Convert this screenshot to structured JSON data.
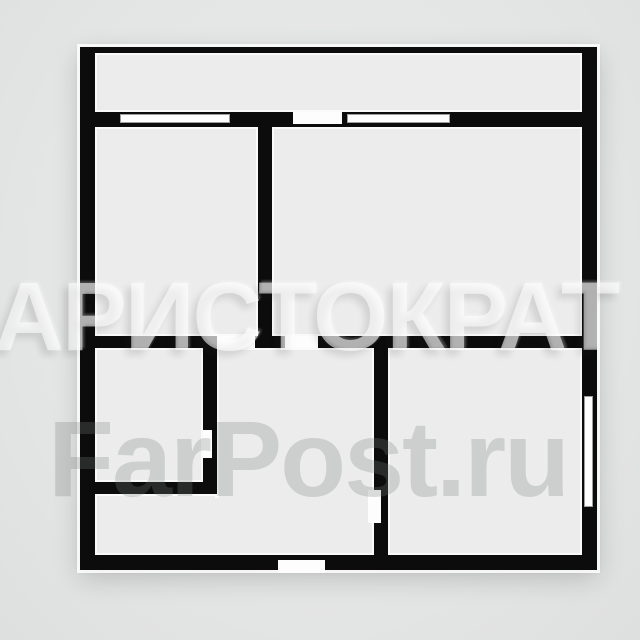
{
  "image_type": "apartment-floor-plan-photo",
  "watermarks": {
    "primary": "АРИСТОКРАТ",
    "secondary": "FarPost.ru"
  },
  "colors": {
    "background": "#e4e5e5",
    "background_light": "#eaebeb",
    "background_dark": "#dedfdf",
    "wall": "#0c0c0c",
    "room_fill": "#ececec",
    "room_edge": "#fafafa",
    "window_border": "#9e9e9e",
    "watermark_primary": "rgba(255,255,255,0.58)",
    "watermark_secondary": "rgba(122,125,125,0.27)"
  },
  "plan": {
    "outer": {
      "x": 80,
      "y": 47,
      "w": 517,
      "h": 523
    },
    "rooms": [
      {
        "name": "balcony-strip",
        "x": 95,
        "y": 53,
        "w": 487,
        "h": 59
      },
      {
        "name": "room-top-left",
        "x": 95,
        "y": 127,
        "w": 163,
        "h": 209
      },
      {
        "name": "room-top-right",
        "x": 272,
        "y": 127,
        "w": 310,
        "h": 209
      },
      {
        "name": "room-small-left",
        "x": 95,
        "y": 348,
        "w": 108,
        "h": 134
      },
      {
        "name": "hallway-main",
        "x": 217,
        "y": 348,
        "w": 157,
        "h": 207
      },
      {
        "name": "hallway-lower-left",
        "x": 95,
        "y": 494,
        "w": 122,
        "h": 61
      },
      {
        "name": "room-bottom-right",
        "x": 388,
        "y": 348,
        "w": 194,
        "h": 207
      }
    ],
    "patches": [
      {
        "name": "hallway-junction-patch",
        "x": 211,
        "y": 498,
        "w": 12,
        "h": 55
      }
    ],
    "openings": [
      {
        "name": "balcony-door-opening",
        "x": 293,
        "y": 112,
        "w": 49,
        "h": 12
      },
      {
        "name": "door-top-left-room",
        "x": 217,
        "y": 336,
        "w": 38,
        "h": 12
      },
      {
        "name": "door-top-right-room",
        "x": 285,
        "y": 336,
        "w": 33,
        "h": 12
      },
      {
        "name": "door-small-left-room",
        "x": 203,
        "y": 430,
        "w": 9,
        "h": 28
      },
      {
        "name": "door-bottom-right-room",
        "x": 368,
        "y": 490,
        "w": 13,
        "h": 33
      },
      {
        "name": "entry-door-opening",
        "x": 278,
        "y": 560,
        "w": 47,
        "h": 13
      }
    ],
    "windows": [
      {
        "name": "balcony-window-left",
        "x": 120,
        "y": 114,
        "w": 110,
        "h": 9
      },
      {
        "name": "balcony-window-right",
        "x": 347,
        "y": 114,
        "w": 103,
        "h": 9
      },
      {
        "name": "right-wall-window",
        "x": 584,
        "y": 396,
        "w": 9,
        "h": 111
      }
    ]
  }
}
